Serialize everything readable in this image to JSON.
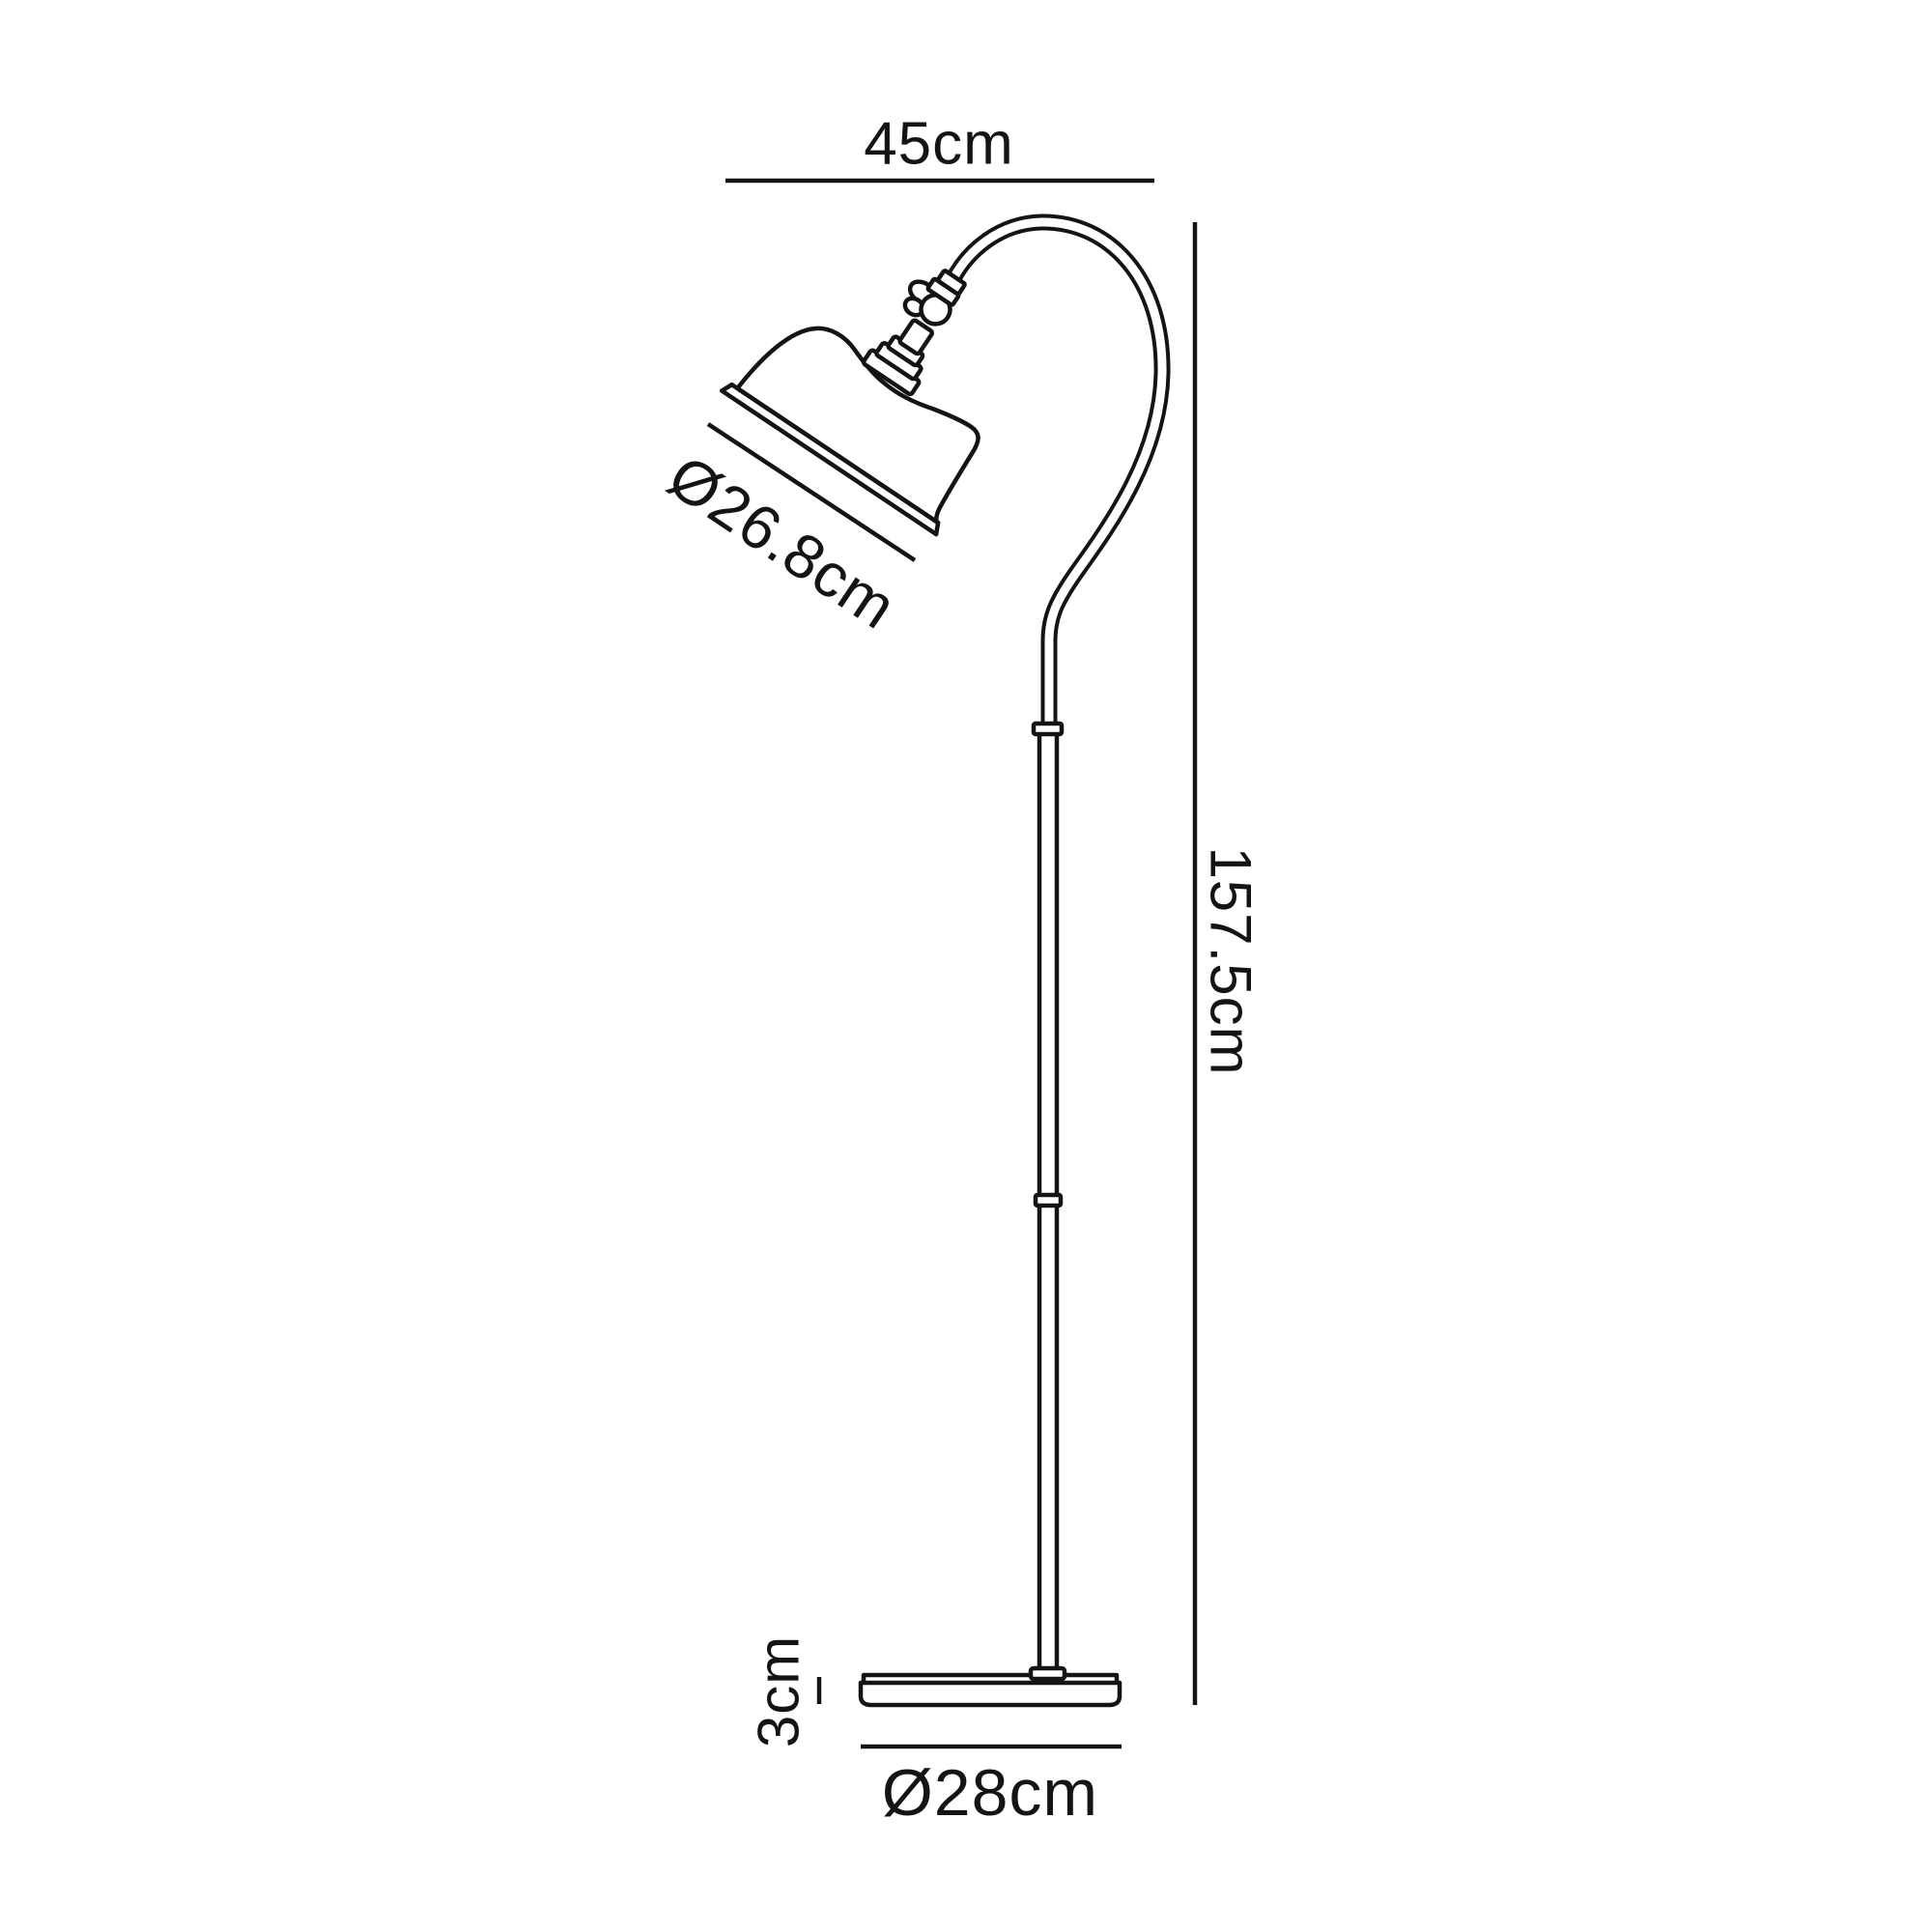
{
  "page": {
    "background": "#ffffff",
    "line_color": "#141414",
    "drawing": "floor-lamp-dimension-diagram"
  },
  "labels": {
    "overall_width": "45cm",
    "overall_height": "157.5cm",
    "shade_diameter": "Ø26.8cm",
    "base_height": "3cm",
    "base_diameter": "Ø28cm"
  }
}
